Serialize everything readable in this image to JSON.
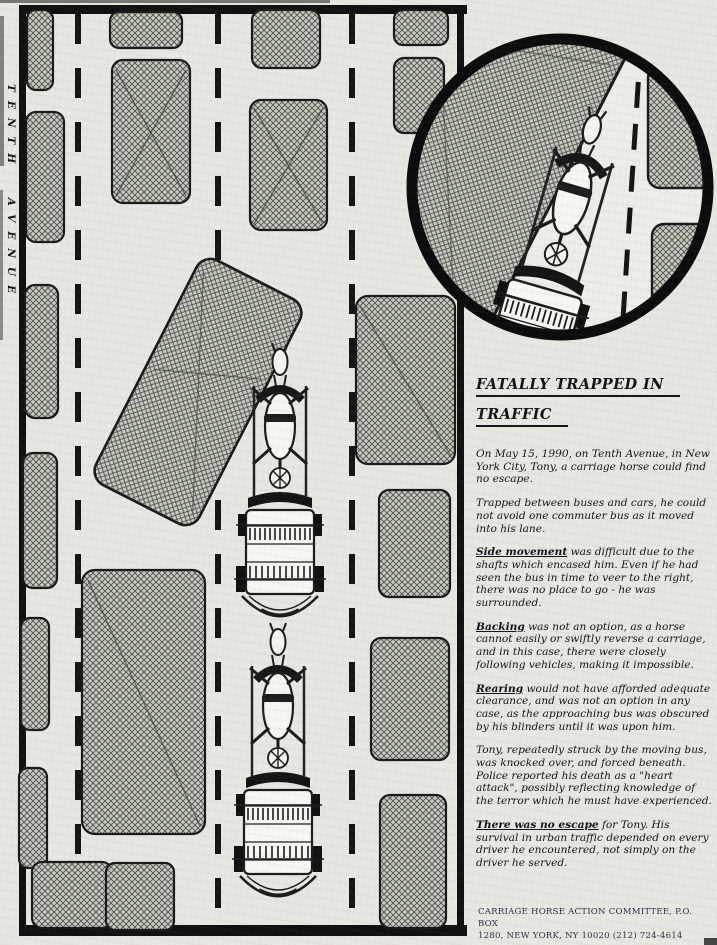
{
  "street_label": "TENTH AVENUE",
  "article": {
    "title_line1": "FATALLY TRAPPED IN",
    "title_line2": "TRAFFIC",
    "paragraphs": [
      {
        "lead": "",
        "text": "On May 15, 1990, on Tenth Avenue, in New York City, Tony, a carriage horse could find no escape."
      },
      {
        "lead": "",
        "text": "Trapped between buses and cars, he could not avoid one commuter bus as it moved into his lane."
      },
      {
        "lead": "Side movement",
        "text": " was difficult due to the shafts which encased him. Even if he had seen the bus in time to veer to the right, there was no place to go - he was surrounded."
      },
      {
        "lead": "Backing",
        "text": " was not an option, as a horse cannot easily or swiftly reverse a carriage, and in this case, there were closely following vehicles, making it impossible."
      },
      {
        "lead": "Rearing",
        "text": " would not have afforded adequate clearance, and was not an option in any case, as the approaching bus was obscured by his blinders until it was upon him."
      },
      {
        "lead": "",
        "text": "Tony, repeatedly struck by the moving bus, was knocked over, and forced beneath. Police reported his death as a \"heart attack\", possibly reflecting knowledge of the terror which he must have experienced."
      },
      {
        "lead": "There was no escape",
        "text": " for Tony.  His survival in urban traffic depended on every driver he encountered, not simply on the driver he served."
      }
    ],
    "footer_line1": "CARRIAGE HORSE ACTION COMMITTEE, P.O. BOX",
    "footer_line2": "1280, NEW YORK, NY  10020  (212) 724-4614"
  },
  "colors": {
    "paper": "#e9e7e1",
    "ink": "#141414",
    "hatch_base": "#c8cbc1",
    "hatch_line": "#4d524a",
    "body_text": "#12121a",
    "footer_text": "#2c3046"
  }
}
